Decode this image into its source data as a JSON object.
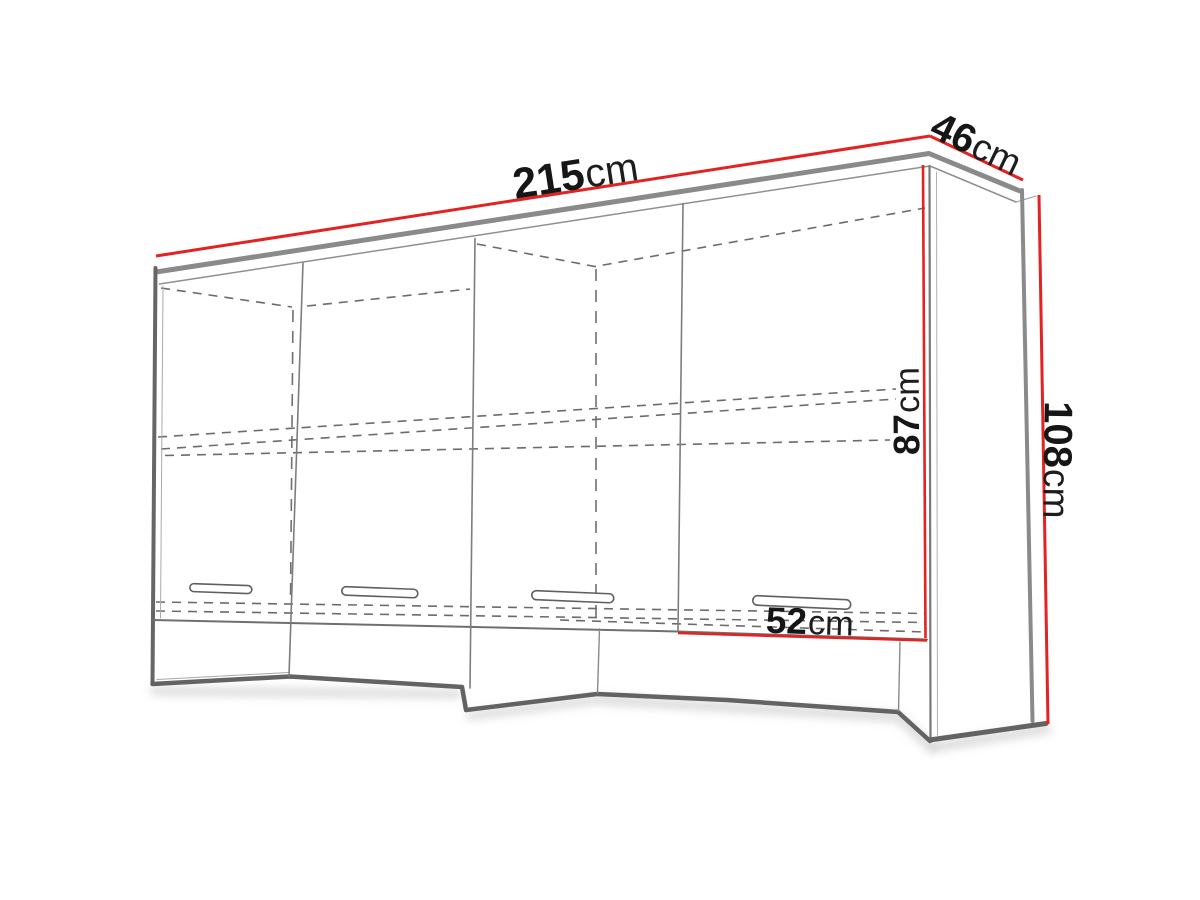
{
  "diagram": {
    "type": "furniture-dimension-diagram",
    "subject": "four-door wall cabinet technical line drawing with red dimension lines",
    "doors": 4,
    "handles": 4,
    "shelf": "dashed hidden shelf lines",
    "dimensions": [
      {
        "label": "overall-width",
        "value": "215",
        "unit": "cm"
      },
      {
        "label": "depth",
        "value": "46",
        "unit": "cm"
      },
      {
        "label": "overall-height",
        "value": "108",
        "unit": "cm"
      },
      {
        "label": "front-height",
        "value": "87",
        "unit": "cm"
      },
      {
        "label": "door-width",
        "value": "52",
        "unit": "cm"
      }
    ],
    "colors": {
      "dimension_line": "#e32222",
      "edge_dark": "#636363",
      "edge_mid": "#8a8a8a",
      "label_text": "#161616",
      "background": "#ffffff"
    }
  }
}
